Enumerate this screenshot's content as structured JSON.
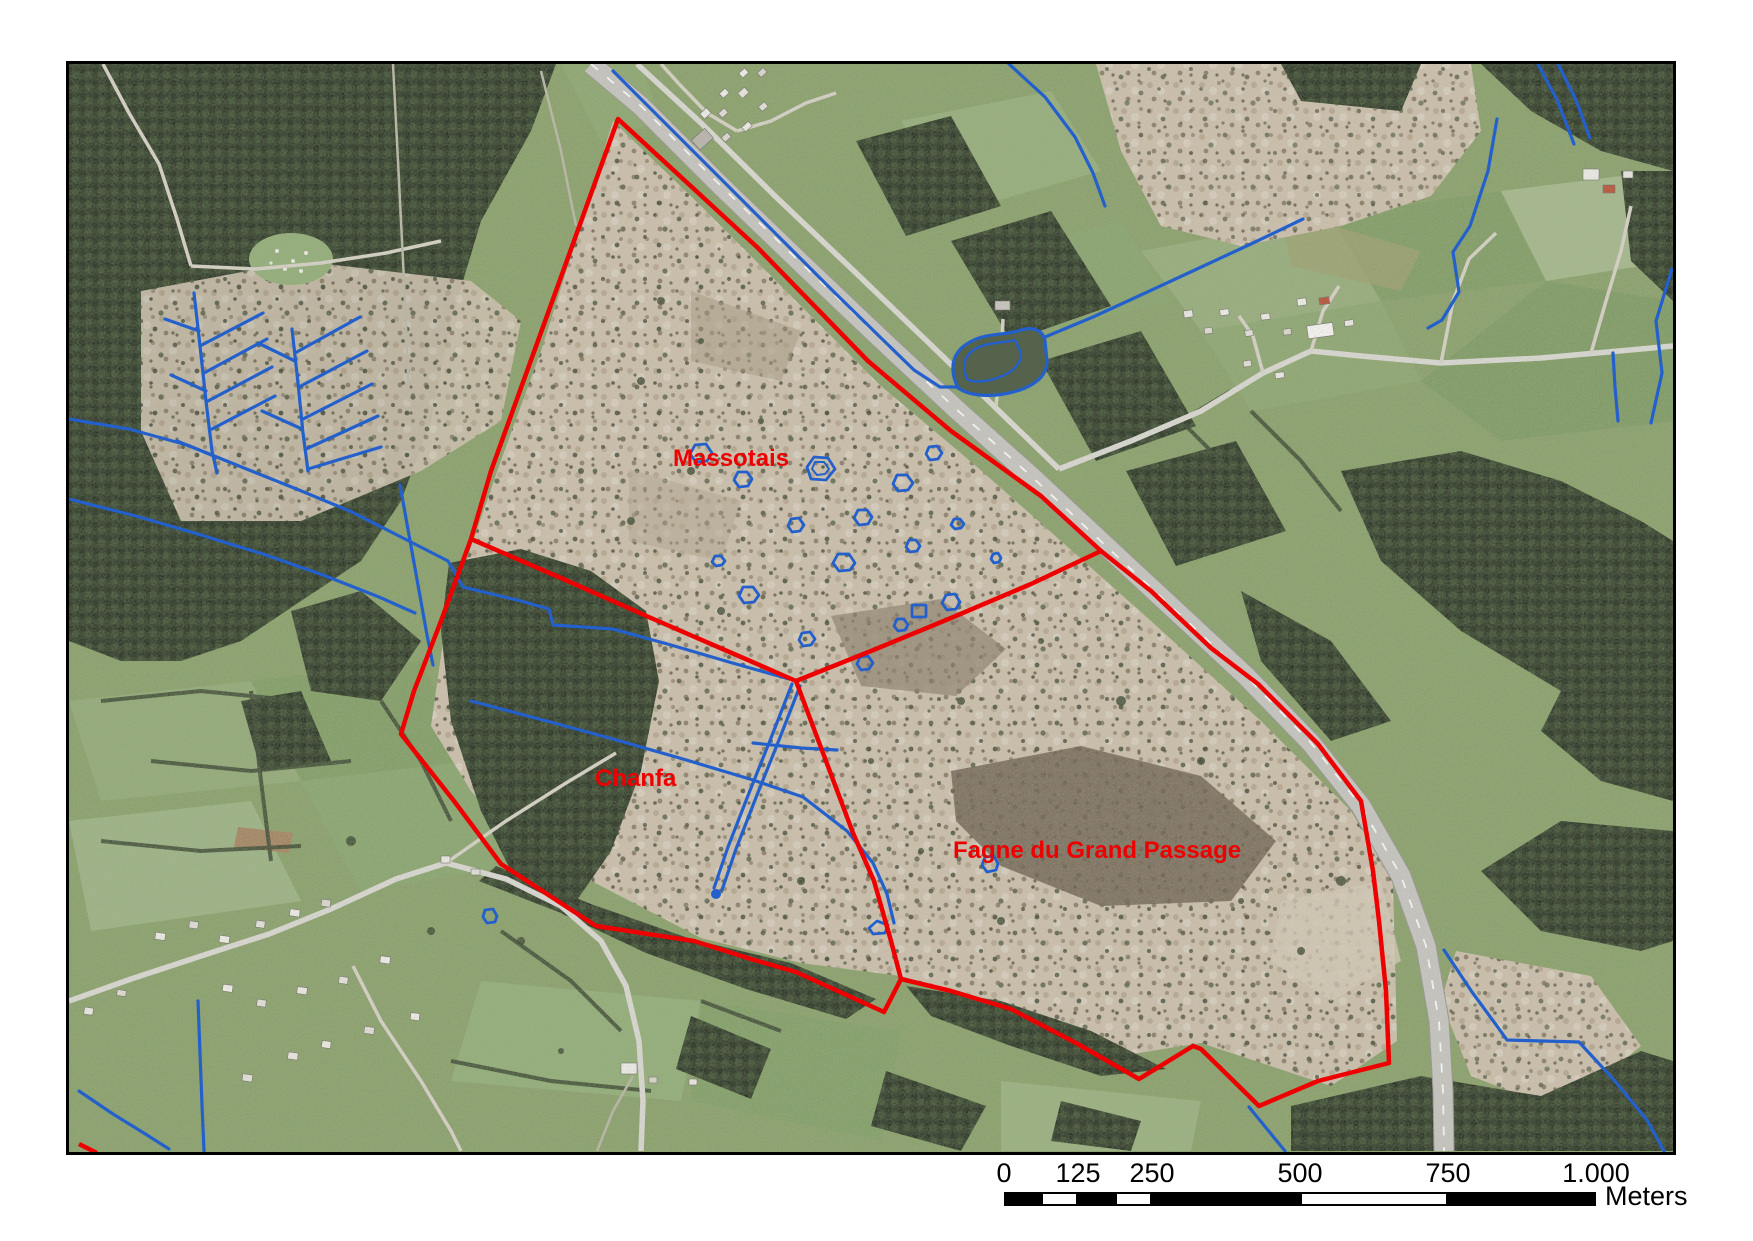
{
  "map": {
    "labels": {
      "massotais": "Massotais",
      "chanfa": "Chanfa",
      "fagne_du_grand_passage": "Fagne du Grand Passage"
    },
    "label_color": "#ee0000"
  },
  "scalebar": {
    "ticks": [
      "0",
      "125",
      "250",
      "500",
      "750",
      "1.000"
    ],
    "unit": "Meters"
  },
  "colors": {
    "boundary_red": "#ee0000",
    "water_blue": "#2360cc"
  }
}
